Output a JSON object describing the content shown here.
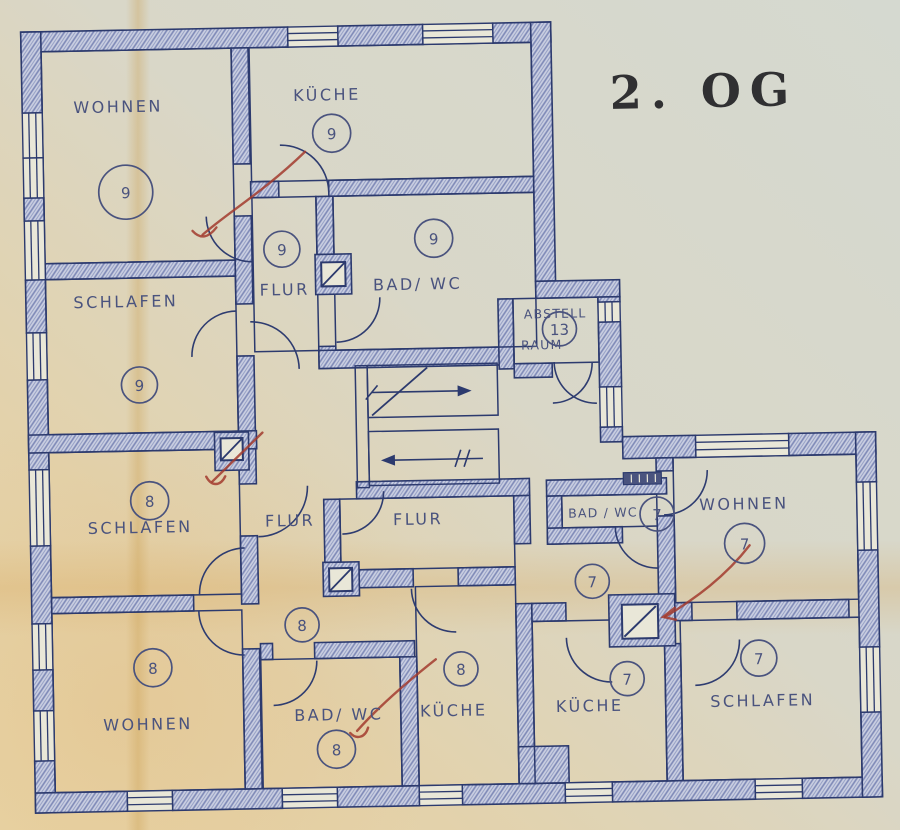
{
  "title": "2. OG",
  "rooms": {
    "wohnen9": "WOHNEN",
    "kueche9": "KÜCHE",
    "schlafen9": "SCHLAFEN",
    "flur9": "FLUR",
    "bad9": "BAD/ WC",
    "abstell1": "ABSTELL",
    "abstell2": "RAUM",
    "schlafen8": "SCHLAFEN",
    "flur8": "FLUR",
    "flur_center": "FLUR",
    "wohnen8": "WOHNEN",
    "bad8": "BAD/ WC",
    "kueche8": "KÜCHE",
    "bad7": "BAD / WC",
    "wohnen7": "WOHNEN",
    "kueche7": "KÜCHE",
    "schlafen7": "SCHLAFEN"
  },
  "numbers": {
    "wohnen9": "9",
    "kueche9": "9",
    "schlafen9": "9",
    "flur9": "9",
    "bad9": "9",
    "abstell": "13",
    "schlafen8": "8",
    "flur8": "8",
    "wohnen8": "8",
    "bad8": "8",
    "kueche8": "8",
    "bad7": "7",
    "hall7": "7",
    "wohnen7": "7",
    "kueche7": "7",
    "schlafen7": "7"
  },
  "colors": {
    "ink": "#2c3a6e",
    "label_text": "#4a537e",
    "wall_fill": "#c9cee1",
    "wall_hatch": "#7d88b6",
    "red_pencil": "#a23b2e",
    "title_ink": "#303032",
    "paper_cool": "#d5d9d0",
    "paper_warm": "#e8d5a8"
  }
}
